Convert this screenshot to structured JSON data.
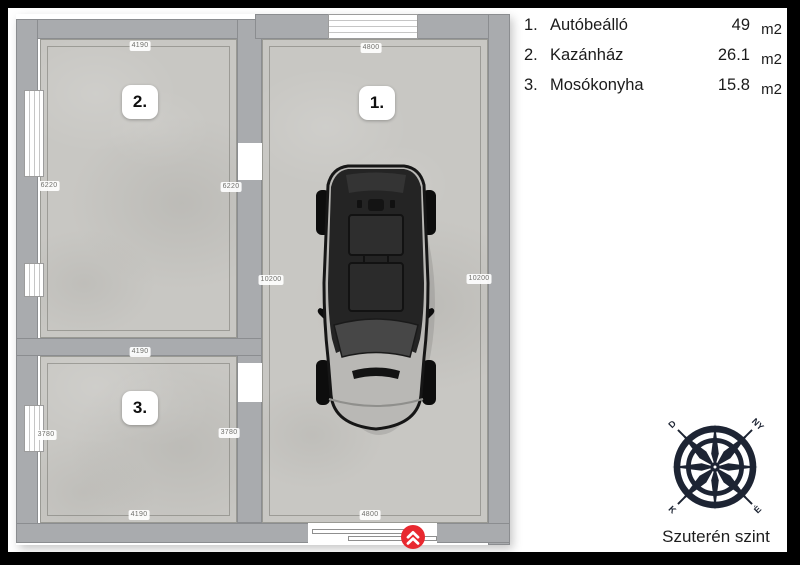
{
  "title": "Szuterén szint",
  "legend": {
    "items": [
      {
        "num": "1.",
        "name": "Autóbeálló",
        "area": "49",
        "unit": "m2"
      },
      {
        "num": "2.",
        "name": "Kazánház",
        "area": "26.1",
        "unit": "m2"
      },
      {
        "num": "3.",
        "name": "Mosókonyha",
        "area": "15.8",
        "unit": "m2"
      }
    ]
  },
  "rooms": {
    "r1": {
      "label": "1."
    },
    "r2": {
      "label": "2."
    },
    "r3": {
      "label": "3."
    }
  },
  "dims": {
    "r2_top": "4190",
    "r2_left": "6220",
    "r2_right": "6220",
    "r1_top": "4800",
    "r1_left": "10200",
    "r1_right": "10200",
    "r1_bottom": "4800",
    "r3_top": "4190",
    "r3_left": "3780",
    "r3_right": "3780",
    "r3_bottom": "4190"
  },
  "compass": {
    "nw": "D",
    "ne": "NY",
    "sw": "K",
    "se": "É"
  },
  "colors": {
    "frame": "#000000",
    "wall": "#a9abae",
    "floor": "#c8c7c3",
    "entrance_red": "#e8282f",
    "compass_navy": "#1d2433",
    "car_body": "#b9b8b5",
    "car_roof": "#242424"
  }
}
